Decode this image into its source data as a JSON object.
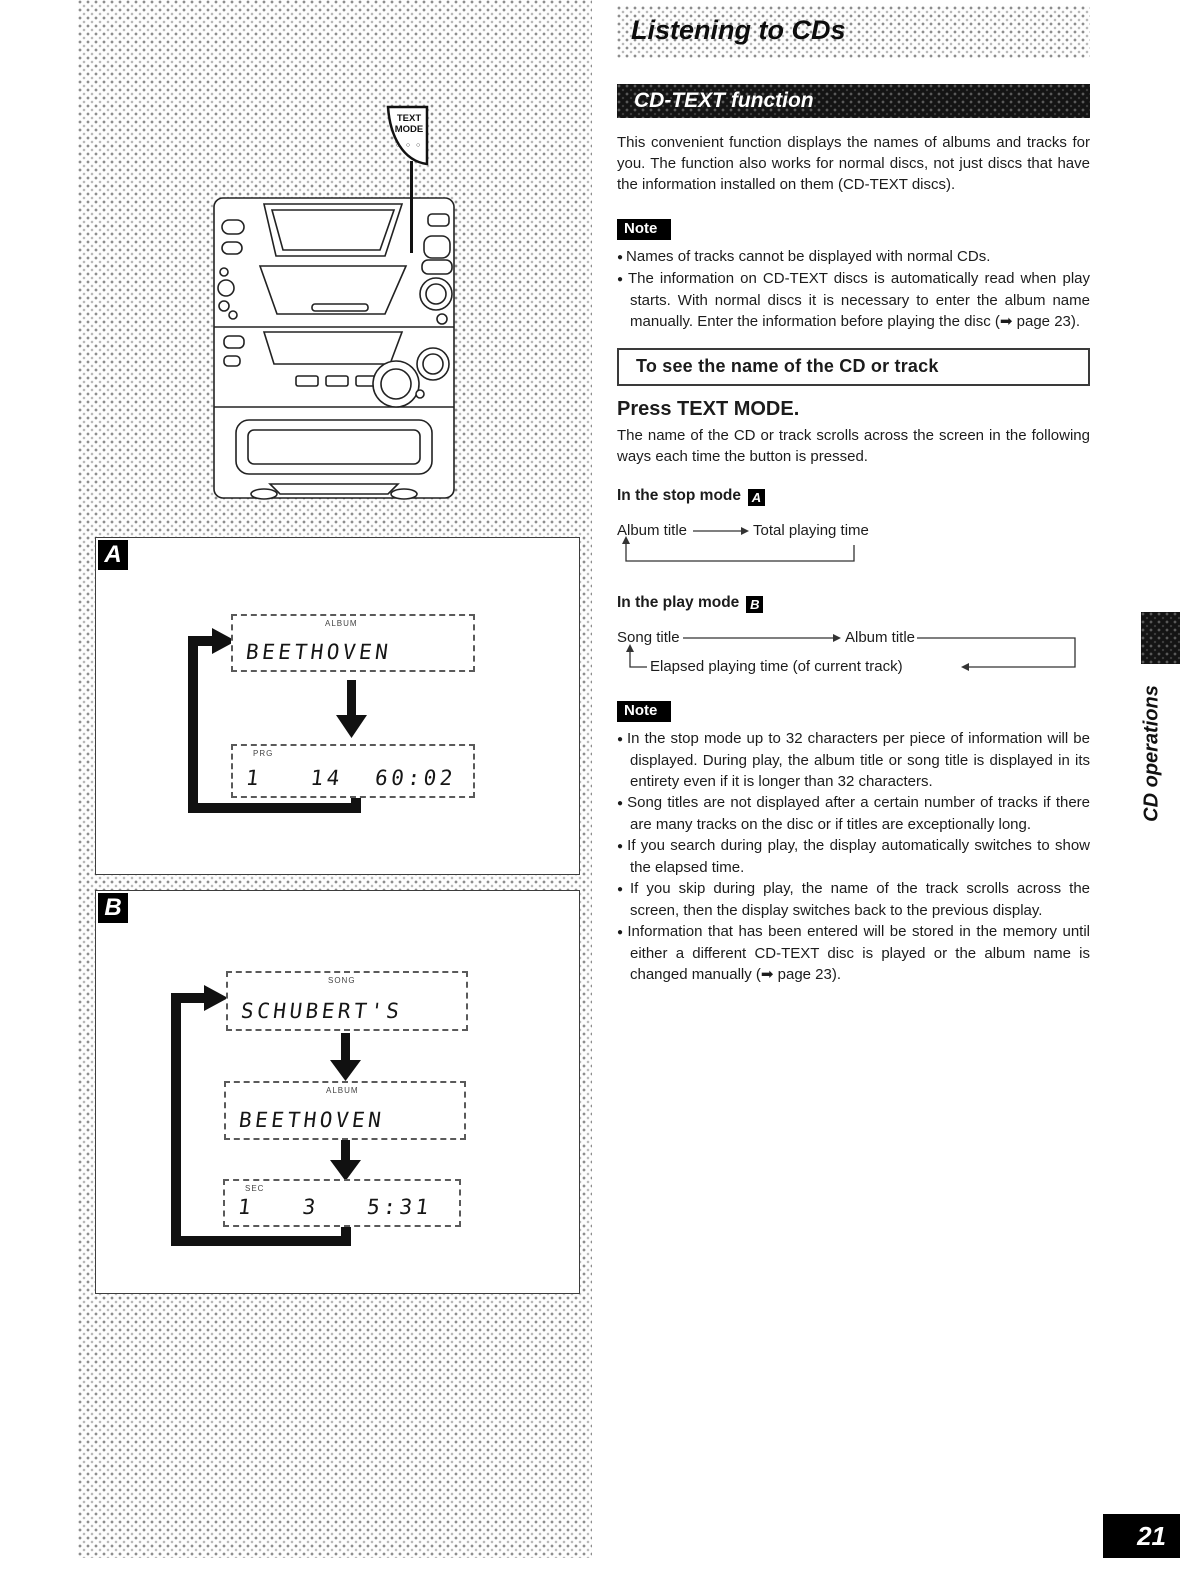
{
  "header": {
    "title": "Listening to CDs"
  },
  "banner": {
    "title": "CD-TEXT function"
  },
  "intro": "This convenient function displays the names of albums and tracks for you. The function also works for normal discs, not just discs that have the information installed on them (CD-TEXT discs).",
  "note_label": "Note",
  "note1": {
    "bullets": [
      "Names of tracks cannot be displayed with normal CDs.",
      "The information on CD-TEXT discs is automatically read when play starts. With normal discs it is necessary to enter the album name manually. Enter the information before playing the disc (➡ page 23)."
    ]
  },
  "boxed_heading": "To see the name of the CD or track",
  "step": {
    "heading": "Press TEXT MODE.",
    "body": "The name of the CD or track scrolls across the screen in the following ways each time the button is pressed."
  },
  "stop_mode": {
    "label": "In the stop mode",
    "marker": "A",
    "from": "Album title",
    "to": "Total playing time"
  },
  "play_mode": {
    "label": "In the play mode",
    "marker": "B",
    "song": "Song title",
    "album": "Album title",
    "elapsed": "Elapsed playing time (of current track)"
  },
  "note2": {
    "bullets": [
      "In the stop mode up to 32 characters per piece of information will be displayed. During play, the album title or song title is displayed in its entirety even if it is longer than 32 characters.",
      "Song titles are not displayed after a certain number of tracks if there are many tracks on the disc or if titles are exceptionally long.",
      "If you search during play, the display automatically switches to show the elapsed time.",
      "If you skip during play, the name of the track scrolls across the screen, then the display switches back to the previous display.",
      "Information that has been entered will be stored in the memory until either a different CD-TEXT disc is played or the album name is changed manually (➡ page 23)."
    ]
  },
  "device": {
    "callout_label": "TEXT MODE",
    "callout_dots": "○ ○ ○"
  },
  "boxA": {
    "label": "A",
    "displays": [
      {
        "indicator": "ALBUM",
        "text": "BEETHOVEN"
      },
      {
        "indicator": "PRG",
        "text": "1   14  60:02"
      }
    ]
  },
  "boxB": {
    "label": "B",
    "displays": [
      {
        "indicator": "SONG",
        "text": "SCHUBERT'S"
      },
      {
        "indicator": "ALBUM",
        "text": "BEETHOVEN"
      },
      {
        "indicator": "SEC",
        "text": "1   3   5:31"
      }
    ]
  },
  "side_tab": "CD operations",
  "page_number": "21"
}
